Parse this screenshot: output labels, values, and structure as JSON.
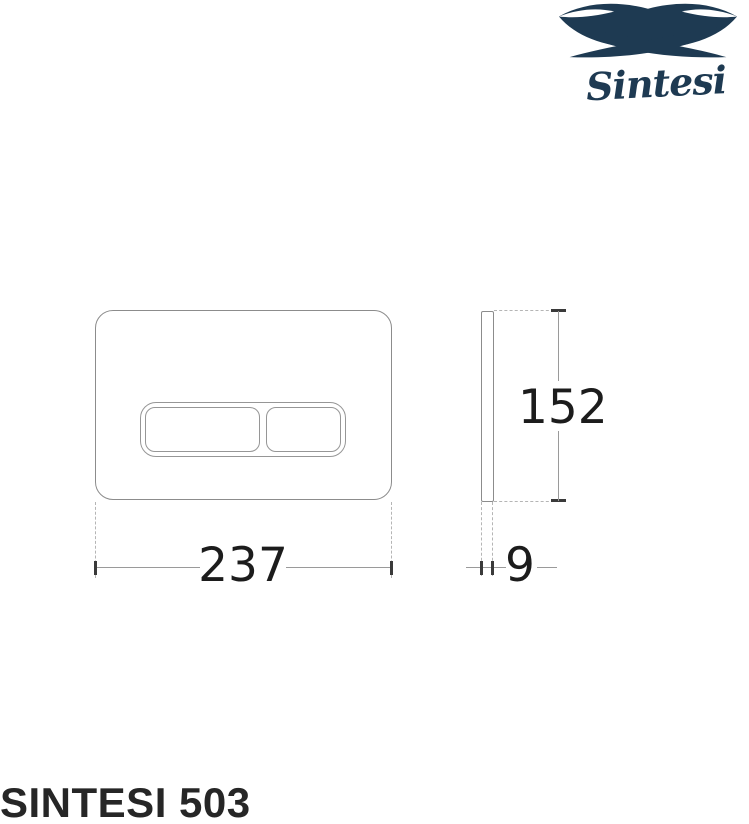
{
  "brand": {
    "name": "Sintesi",
    "color": "#1e3a52"
  },
  "product": {
    "model": "SINTESI 503"
  },
  "diagram": {
    "type": "technical-dimension-drawing",
    "subject": "toilet flush plate with two buttons",
    "front_view": {
      "width_mm": "237",
      "height_mm": "152"
    },
    "side_view": {
      "depth_mm": "9"
    }
  },
  "colors": {
    "background": "#ffffff",
    "outline_gray": "#8c8c8c",
    "dimension_line_gray": "#9a9a9a",
    "dimension_text": "#1c1c1c",
    "brand_navy": "#1e3a52"
  }
}
